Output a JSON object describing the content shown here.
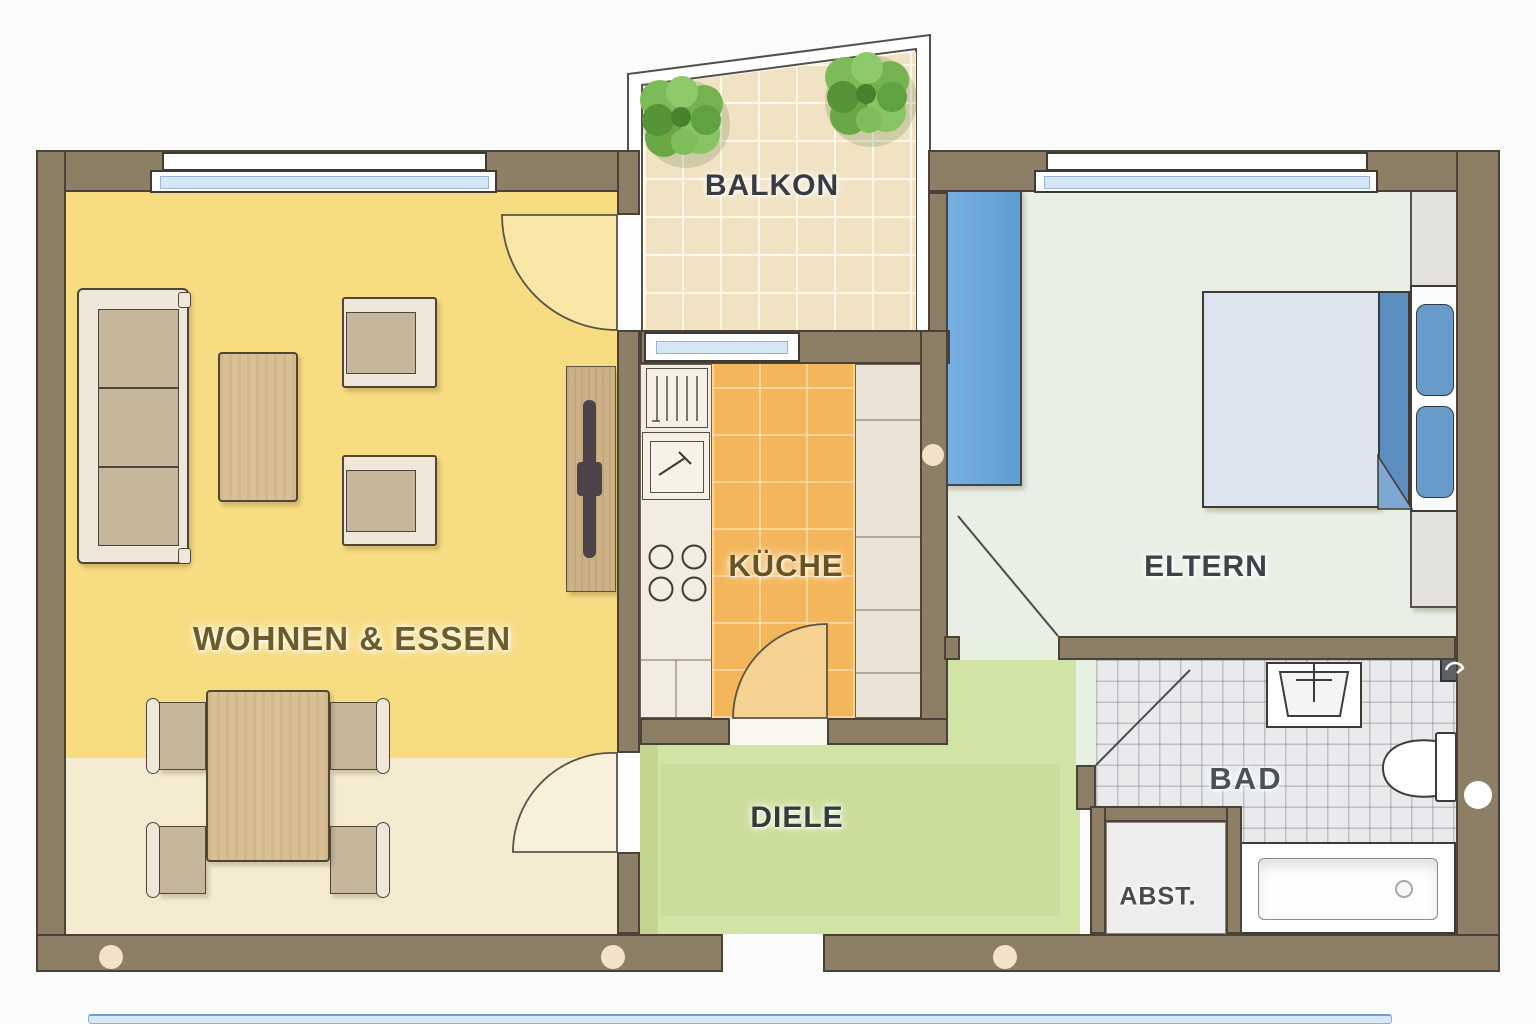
{
  "title": "apartment-floor-plan",
  "rooms": [
    {
      "id": "balkon",
      "label": "BALKON"
    },
    {
      "id": "wohnen-essen",
      "label": "WOHNEN & ESSEN"
    },
    {
      "id": "kueche",
      "label": "KÜCHE"
    },
    {
      "id": "eltern",
      "label": "ELTERN"
    },
    {
      "id": "diele",
      "label": "DIELE"
    },
    {
      "id": "bad",
      "label": "BAD"
    },
    {
      "id": "abstellraum",
      "label": "ABST."
    }
  ],
  "colors": {
    "wall": "#8d7e66",
    "wall_outline": "#4a4238",
    "living_yellow": "#f8dc82",
    "living_beige": "#f4ebd1",
    "kitchen_orange": "#f4b65a",
    "hall_green": "#d2e3a6",
    "bedroom_sage": "#e9efe5",
    "balcony_tile": "#f0e2c2",
    "bath_tile": "#e9eaec",
    "wardrobe_blue": "#6da7dd",
    "bed_blanket_blue": "#5d8ec0",
    "pillow_blue": "#689bc9",
    "window_glass": "#d6e6f7",
    "wood": "#d9c094",
    "furniture_cream": "#efe8da",
    "cushion_tan": "#c6b69b",
    "plant_green": "#6fae4e",
    "door_swing_yellow": "#f9e7a8"
  },
  "icons": {
    "balcony-plant-icon": "svg-shape",
    "door-swing-icon": "svg-shape",
    "window": "css-shape",
    "sofa": "css-shape",
    "coffee-table": "css-shape",
    "armchair": "css-shape",
    "dining-table": "css-shape",
    "dining-chair": "css-shape",
    "tv-sideboard": "css-shape",
    "dish-rack": "svg-shape",
    "kitchen-sink": "svg-shape",
    "stove": "svg-shape",
    "wardrobe": "css-shape",
    "double-bed": "css-shape",
    "pillow": "css-shape",
    "nightstand": "css-shape",
    "closet": "css-shape",
    "washbasin": "svg-shape",
    "toilet": "svg-shape",
    "bathtub": "css-shape",
    "paper-holder-icon": "svg-shape"
  }
}
